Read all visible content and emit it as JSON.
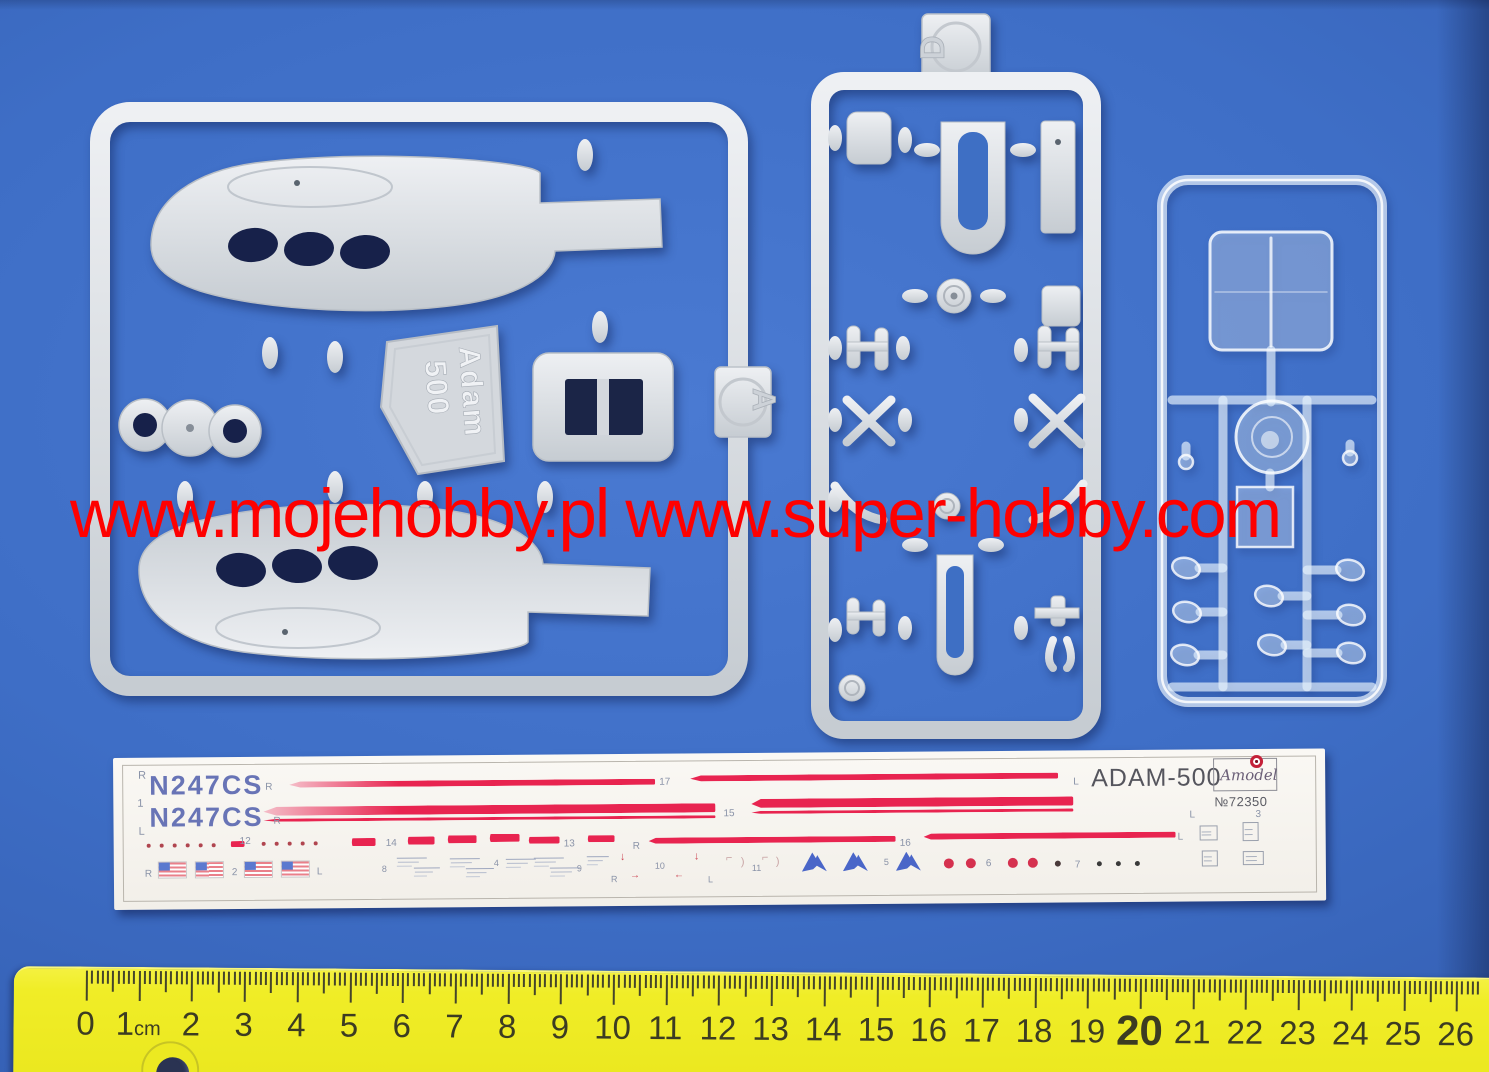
{
  "photo": {
    "background_color": "#3e6ec6",
    "watermark_text": "www.mojehobby.pl www.super-hobby.com",
    "watermark_color": "#fe0000"
  },
  "sprue_a": {
    "tag": "A",
    "embossed_line1": "Adam",
    "embossed_line2": "500",
    "plastic_color": "#d9dde1"
  },
  "sprue_d": {
    "tag": "D"
  },
  "decal_sheet": {
    "registration_1": "N247CS",
    "registration_2": "N247CS",
    "title": "ADAM-500",
    "brand": "Amodel",
    "catalog_number": "№72350",
    "stripe_color": "#e82450",
    "labels": [
      {
        "t": "R",
        "x": 25,
        "y": 13,
        "s": 11
      },
      {
        "t": "1",
        "x": 24,
        "y": 41,
        "s": 11
      },
      {
        "t": "L",
        "x": 25,
        "y": 69,
        "s": 11
      },
      {
        "t": "R",
        "x": 152,
        "y": 26,
        "s": 10
      },
      {
        "t": "R",
        "x": 160,
        "y": 60,
        "s": 10
      },
      {
        "t": "17",
        "x": 546,
        "y": 24,
        "s": 10
      },
      {
        "t": "15",
        "x": 610,
        "y": 56,
        "s": 10
      },
      {
        "t": "12",
        "x": 126,
        "y": 80,
        "s": 10
      },
      {
        "t": "14",
        "x": 272,
        "y": 83,
        "s": 10
      },
      {
        "t": "13",
        "x": 450,
        "y": 85,
        "s": 10
      },
      {
        "t": "R",
        "x": 519,
        "y": 88,
        "s": 10
      },
      {
        "t": "16",
        "x": 786,
        "y": 87,
        "s": 10
      },
      {
        "t": "L",
        "x": 960,
        "y": 27,
        "s": 10
      },
      {
        "t": "L",
        "x": 1076,
        "y": 61,
        "s": 10
      },
      {
        "t": "L",
        "x": 1064,
        "y": 83,
        "s": 10
      },
      {
        "t": "3",
        "x": 1142,
        "y": 61,
        "s": 10
      },
      {
        "t": "R",
        "x": 31,
        "y": 112,
        "s": 10
      },
      {
        "t": "2",
        "x": 118,
        "y": 111,
        "s": 10
      },
      {
        "t": "L",
        "x": 203,
        "y": 111,
        "s": 10
      },
      {
        "t": "8",
        "x": 268,
        "y": 109,
        "s": 9
      },
      {
        "t": "4",
        "x": 380,
        "y": 104,
        "s": 9
      },
      {
        "t": "9",
        "x": 463,
        "y": 110,
        "s": 9
      },
      {
        "t": "R",
        "x": 497,
        "y": 121,
        "s": 9
      },
      {
        "t": "10",
        "x": 541,
        "y": 108,
        "s": 9
      },
      {
        "t": "L",
        "x": 594,
        "y": 122,
        "s": 9
      },
      {
        "t": "11",
        "x": 638,
        "y": 111,
        "s": 9
      },
      {
        "t": "5",
        "x": 770,
        "y": 106,
        "s": 9
      },
      {
        "t": "6",
        "x": 872,
        "y": 108,
        "s": 10
      },
      {
        "t": "7",
        "x": 961,
        "y": 110,
        "s": 10
      },
      {
        "t": "↓",
        "x": 506,
        "y": 98,
        "s": 11,
        "c": "#cc4452"
      },
      {
        "t": "↓",
        "x": 580,
        "y": 98,
        "s": 11,
        "c": "#cc4452"
      },
      {
        "t": "→",
        "x": 516,
        "y": 117,
        "s": 10,
        "c": "#cc4452"
      },
      {
        "t": "←",
        "x": 560,
        "y": 117,
        "s": 10,
        "c": "#cc4452"
      },
      {
        "t": "⌐",
        "x": 612,
        "y": 100,
        "s": 11,
        "c": "#c9a5a5"
      },
      {
        "t": ")",
        "x": 627,
        "y": 104,
        "s": 11,
        "c": "#c9a5a5"
      },
      {
        "t": "⌐",
        "x": 648,
        "y": 100,
        "s": 11,
        "c": "#c9a5a5"
      },
      {
        "t": ")",
        "x": 662,
        "y": 104,
        "s": 11,
        "c": "#c9a5a5"
      }
    ],
    "stripes": [
      {
        "x": 176,
        "y": 25,
        "w": 366,
        "h": 6,
        "fade": true
      },
      {
        "x": 577,
        "y": 22,
        "w": 368,
        "h": 6
      },
      {
        "x": 150,
        "y": 50,
        "w": 452,
        "h": 9,
        "fade": true
      },
      {
        "x": 150,
        "y": 62,
        "w": 452,
        "h": 3
      },
      {
        "x": 638,
        "y": 46,
        "w": 322,
        "h": 9
      },
      {
        "x": 638,
        "y": 58,
        "w": 322,
        "h": 3
      },
      {
        "x": 117,
        "y": 84,
        "w": 14,
        "h": 6
      },
      {
        "x": 238,
        "y": 82,
        "w": 24,
        "h": 8
      },
      {
        "x": 294,
        "y": 81,
        "w": 27,
        "h": 8
      },
      {
        "x": 334,
        "y": 80,
        "w": 29,
        "h": 8
      },
      {
        "x": 376,
        "y": 79,
        "w": 30,
        "h": 8
      },
      {
        "x": 415,
        "y": 82,
        "w": 31,
        "h": 7
      },
      {
        "x": 474,
        "y": 81,
        "w": 27,
        "h": 7
      },
      {
        "x": 535,
        "y": 84,
        "w": 247,
        "h": 6
      },
      {
        "x": 810,
        "y": 82,
        "w": 252,
        "h": 6
      }
    ],
    "dots": [
      {
        "x": 33,
        "y": 86,
        "r": 2,
        "c": "#b0454f"
      },
      {
        "x": 46,
        "y": 86,
        "r": 2,
        "c": "#b0454f"
      },
      {
        "x": 59,
        "y": 86,
        "r": 2,
        "c": "#b0454f"
      },
      {
        "x": 72,
        "y": 86,
        "r": 2,
        "c": "#b0454f"
      },
      {
        "x": 85,
        "y": 86,
        "r": 2,
        "c": "#b0454f"
      },
      {
        "x": 98,
        "y": 86,
        "r": 2,
        "c": "#b0454f"
      },
      {
        "x": 148,
        "y": 85,
        "r": 2,
        "c": "#b0454f"
      },
      {
        "x": 161,
        "y": 85,
        "r": 2,
        "c": "#b0454f"
      },
      {
        "x": 174,
        "y": 85,
        "r": 2,
        "c": "#b0454f"
      },
      {
        "x": 187,
        "y": 85,
        "r": 2,
        "c": "#b0454f"
      },
      {
        "x": 200,
        "y": 85,
        "r": 2,
        "c": "#b0454f"
      },
      {
        "x": 830,
        "y": 107,
        "r": 5,
        "c": "#d5314f"
      },
      {
        "x": 852,
        "y": 107,
        "r": 5,
        "c": "#d5314f"
      },
      {
        "x": 894,
        "y": 107,
        "r": 5,
        "c": "#d5314f"
      },
      {
        "x": 914,
        "y": 107,
        "r": 5,
        "c": "#d5314f"
      },
      {
        "x": 941,
        "y": 110,
        "r": 3,
        "c": "#4a3a3a"
      },
      {
        "x": 983,
        "y": 111,
        "r": 2.5,
        "c": "#3a3a3a"
      },
      {
        "x": 1002,
        "y": 111,
        "r": 2.5,
        "c": "#3a3a3a"
      },
      {
        "x": 1021,
        "y": 111,
        "r": 2.5,
        "c": "#3a3a3a"
      }
    ],
    "flags": [
      {
        "x": 45,
        "y": 105
      },
      {
        "x": 82,
        "y": 105
      },
      {
        "x": 131,
        "y": 105
      },
      {
        "x": 168,
        "y": 105
      }
    ],
    "a_logos": [
      {
        "x": 688,
        "y": 100
      },
      {
        "x": 729,
        "y": 100
      },
      {
        "x": 782,
        "y": 100
      }
    ],
    "micros": [
      {
        "x": 283,
        "y": 102,
        "w": 30
      },
      {
        "x": 300,
        "y": 112,
        "w": 26
      },
      {
        "x": 336,
        "y": 103,
        "w": 30
      },
      {
        "x": 352,
        "y": 113,
        "w": 28
      },
      {
        "x": 392,
        "y": 104,
        "w": 30
      },
      {
        "x": 420,
        "y": 103,
        "w": 30
      },
      {
        "x": 436,
        "y": 113,
        "w": 30
      },
      {
        "x": 473,
        "y": 102,
        "w": 22
      }
    ],
    "micro_boxes": [
      {
        "x": 1086,
        "y": 76,
        "w": 16,
        "h": 13
      },
      {
        "x": 1129,
        "y": 73,
        "w": 14,
        "h": 17
      },
      {
        "x": 1088,
        "y": 101,
        "w": 14,
        "h": 14
      },
      {
        "x": 1129,
        "y": 102,
        "w": 19,
        "h": 12
      }
    ]
  },
  "ruler": {
    "unit_suffix": "cm",
    "zero_x": 72,
    "cm_px": 52.7,
    "tick_color": "#45452a",
    "numbers": [
      {
        "t": "0"
      },
      {
        "t": "1",
        "unit": true
      },
      {
        "t": "2"
      },
      {
        "t": "3"
      },
      {
        "t": "4"
      },
      {
        "t": "5"
      },
      {
        "t": "6"
      },
      {
        "t": "7"
      },
      {
        "t": "8"
      },
      {
        "t": "9"
      },
      {
        "t": "10"
      },
      {
        "t": "11"
      },
      {
        "t": "12"
      },
      {
        "t": "13"
      },
      {
        "t": "14"
      },
      {
        "t": "15"
      },
      {
        "t": "16"
      },
      {
        "t": "17"
      },
      {
        "t": "18"
      },
      {
        "t": "19"
      },
      {
        "t": "20",
        "big": true
      },
      {
        "t": "21"
      },
      {
        "t": "22"
      },
      {
        "t": "23"
      },
      {
        "t": "24"
      },
      {
        "t": "25"
      },
      {
        "t": "26"
      }
    ]
  }
}
